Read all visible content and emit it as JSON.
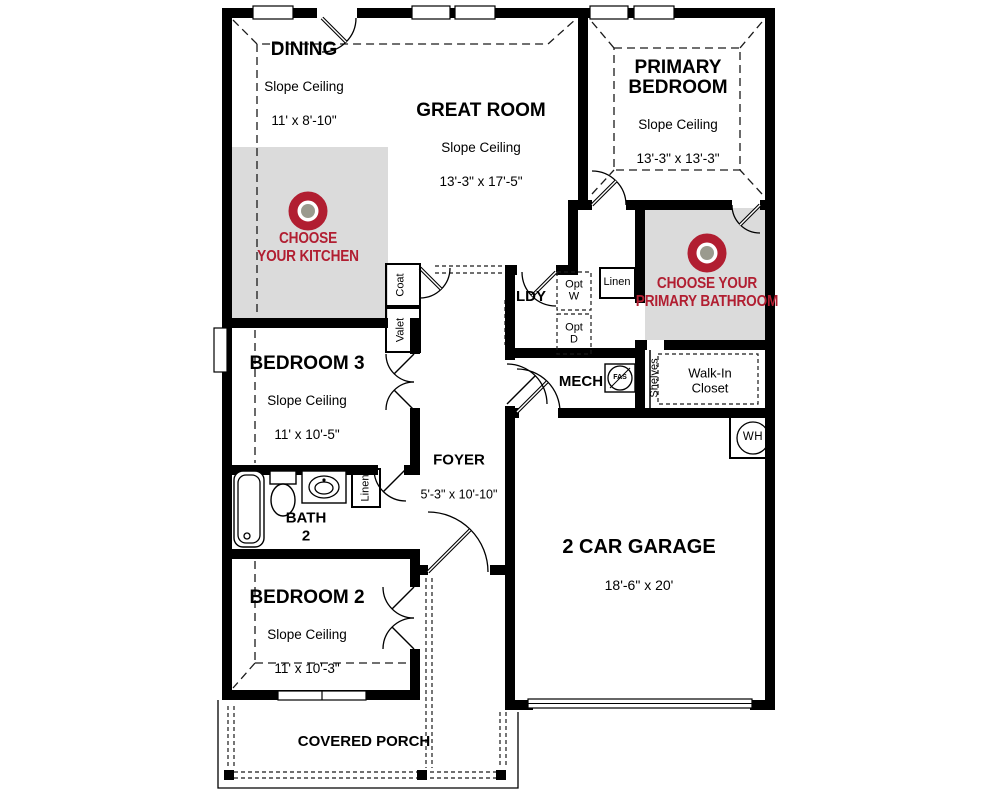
{
  "plan": {
    "rooms": {
      "dining": {
        "name": "DINING",
        "ceiling": "Slope Ceiling",
        "dims": "11' x 8'-10\""
      },
      "great_room": {
        "name": "GREAT ROOM",
        "ceiling": "Slope Ceiling",
        "dims": "13'-3\" x 17'-5\""
      },
      "primary_bedroom": {
        "name": "PRIMARY\nBEDROOM",
        "ceiling": "Slope Ceiling",
        "dims": "13'-3\" x 13'-3\""
      },
      "bedroom3": {
        "name": "BEDROOM 3",
        "ceiling": "Slope Ceiling",
        "dims": "11' x 10'-5\""
      },
      "bedroom2": {
        "name": "BEDROOM 2",
        "ceiling": "Slope Ceiling",
        "dims": "11' x 10'-3\""
      },
      "bath2": {
        "name": "BATH\n2"
      },
      "foyer": {
        "name": "FOYER",
        "dims": "5'-3\" x 10'-10\""
      },
      "garage": {
        "name": "2 CAR GARAGE",
        "dims": "18'-6\" x 20'"
      },
      "laundry": {
        "name": "LDY"
      },
      "mech": {
        "name": "MECH"
      },
      "porch": {
        "name": "COVERED PORCH"
      },
      "walk_in_closet": {
        "name": "Walk-In\nCloset"
      }
    },
    "labels": {
      "coat": "Coat",
      "valet": "Valet",
      "linen_hall": "Linen",
      "linen_bath": "Linen",
      "shelves": "Shelves",
      "opt_washer": "Opt\nW",
      "opt_dryer": "Opt\nD",
      "water_heater": "WH",
      "fas": "FAS"
    },
    "badges": {
      "kitchen": {
        "text": "CHOOSE\nYOUR KITCHEN"
      },
      "primary_bathroom": {
        "text": "CHOOSE YOUR\nPRIMARY BATHROOM"
      }
    },
    "colors": {
      "badge_red": "#b11e31",
      "selection_gray": "#dbdbdb",
      "target_center_gray": "#9a9a8e",
      "wall_black": "#000000"
    }
  }
}
